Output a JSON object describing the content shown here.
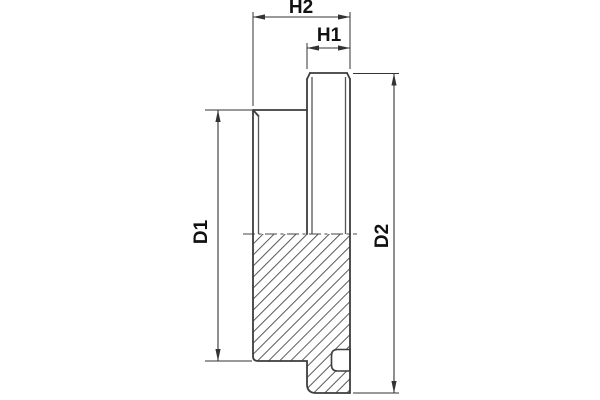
{
  "drawing": {
    "kind": "technical-section-drawing",
    "dimension_labels": {
      "h2": "H2",
      "h1": "H1",
      "d1": "D1",
      "d2": "D2"
    },
    "colors": {
      "background": "#ffffff",
      "outline": "#3d3d3d",
      "dimension_lines": "#333333",
      "hatch": "#5a5a5a",
      "text": "#111111"
    }
  }
}
